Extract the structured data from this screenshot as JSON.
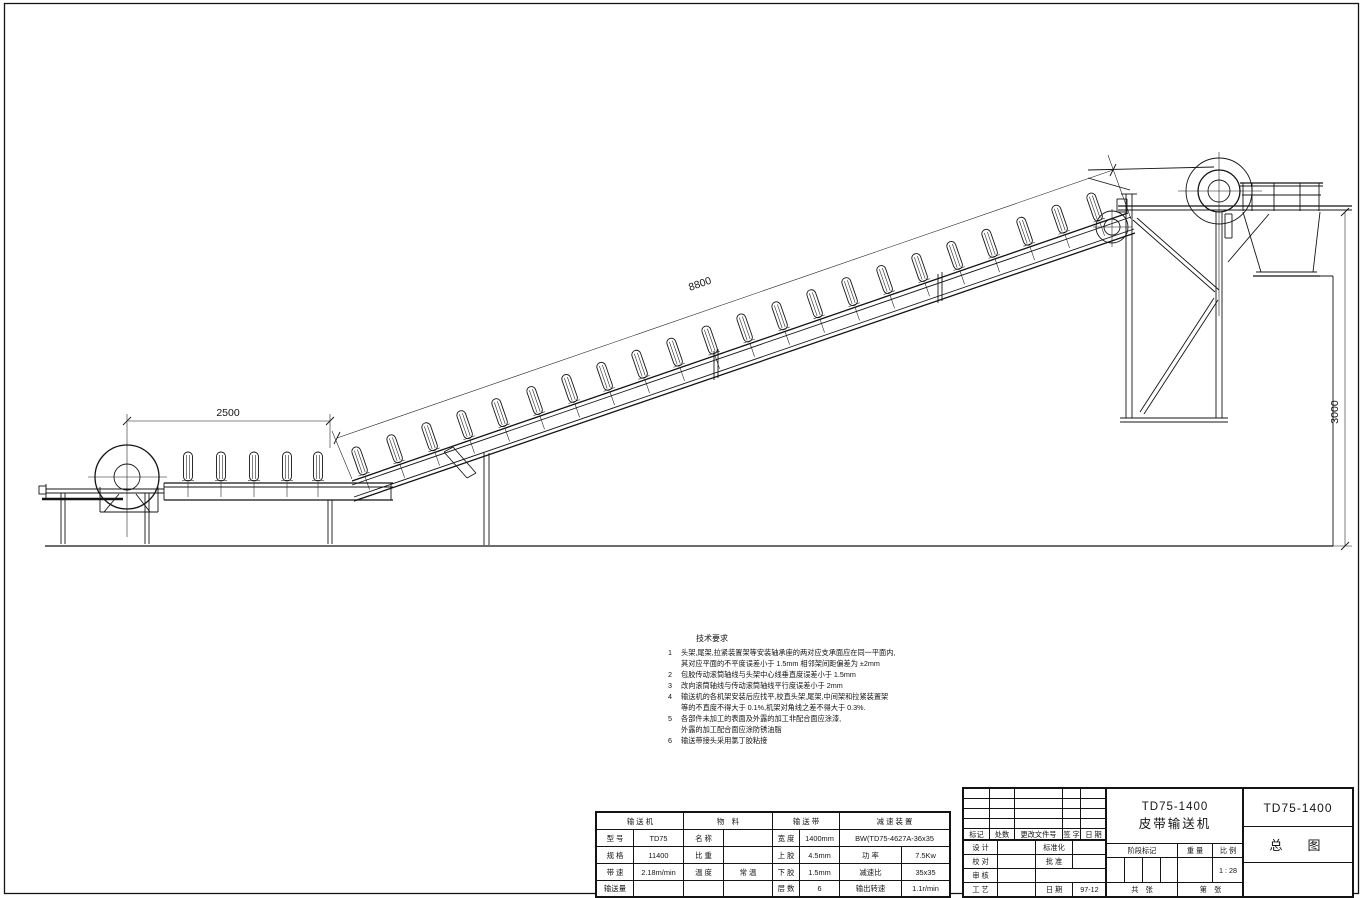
{
  "drawing_labels": {
    "dim_horizontal": "2500",
    "dim_incline": "8800",
    "dim_vertical": "3000"
  },
  "tech_notes": {
    "title": "技术要求",
    "lines": [
      {
        "no": "1",
        "text": "头架,尾架,拉紧装置架等安装轴承座的两对应支承面应在同一平面内,"
      },
      {
        "no": "",
        "text": "其对应平面的不平度误差小于 1.5mm 相邻架间距偏差为  ±2mm"
      },
      {
        "no": "2",
        "text": "包胶传动滚筒轴线与头架中心线垂直度误差小于  1.5mm"
      },
      {
        "no": "3",
        "text": "改向滚筒轴线与传动滚筒轴线平行度误差小于  2mm"
      },
      {
        "no": "4",
        "text": "输送机的各机架安装后应找平,校直头架,尾架,中间架和拉紧装置架"
      },
      {
        "no": "",
        "text": "等的不直度不得大于 0.1%,机架对角线之差不得大于   0.3%."
      },
      {
        "no": "5",
        "text": "各部件未加工的表面及外露的加工非配合面应涂漆,"
      },
      {
        "no": "",
        "text": "外露的加工配合面应涂防锈油脂"
      },
      {
        "no": "6",
        "text": "输送带接头采用氯丁胶粘接"
      }
    ]
  },
  "param_table": {
    "headers": {
      "conveyor": "输 送 机",
      "material": "物　料",
      "belt": "输 送 带",
      "reducer": "减 速 装 置"
    },
    "conveyor": {
      "model_label": "型  号",
      "model": "TD75",
      "spec_label": "规  格",
      "spec": "11400",
      "speed_label": "带  速",
      "speed": "2.18m/min",
      "capacity_label": "输送量"
    },
    "material": {
      "name_label": "名  称",
      "gravity_label": "比  重",
      "temp_label": "温  度",
      "temp": "常  温"
    },
    "belt": {
      "width_label": "宽  度",
      "width": "1400mm",
      "top_label": "上  胶",
      "top": "4.5mm",
      "bottom_label": "下  胶",
      "bottom": "1.5mm",
      "plies_label": "层  数",
      "plies": "6"
    },
    "reducer": {
      "model": "BW(TD75-4627A-36x35",
      "power_label": "功  率",
      "power": "7.5Kw",
      "ratio_label": "减速比",
      "ratio": "35x35",
      "output_label": "输出转速",
      "output": "1.1r/min"
    }
  },
  "title_block": {
    "rev": {
      "mark": "标记",
      "count": "处数",
      "doc": "更改文件号",
      "sign": "签 字",
      "date": "日 期"
    },
    "roles": {
      "design": "设  计",
      "standardize": "标准化",
      "check": "校  对",
      "approve": "批  准",
      "audit": "审  核",
      "process": "工  艺",
      "date_label": "日  期",
      "date_value": "97-12"
    },
    "stage": {
      "label": "阶段标记",
      "weight": "重 量",
      "scale_label": "比 例",
      "scale": "1 : 28"
    },
    "sheets": {
      "total": "共　张",
      "page": "第　张"
    },
    "product": {
      "model": "TD75-1400",
      "name": "皮带输送机"
    },
    "sheet_title": {
      "model": "TD75-1400",
      "type": "总　图"
    }
  }
}
